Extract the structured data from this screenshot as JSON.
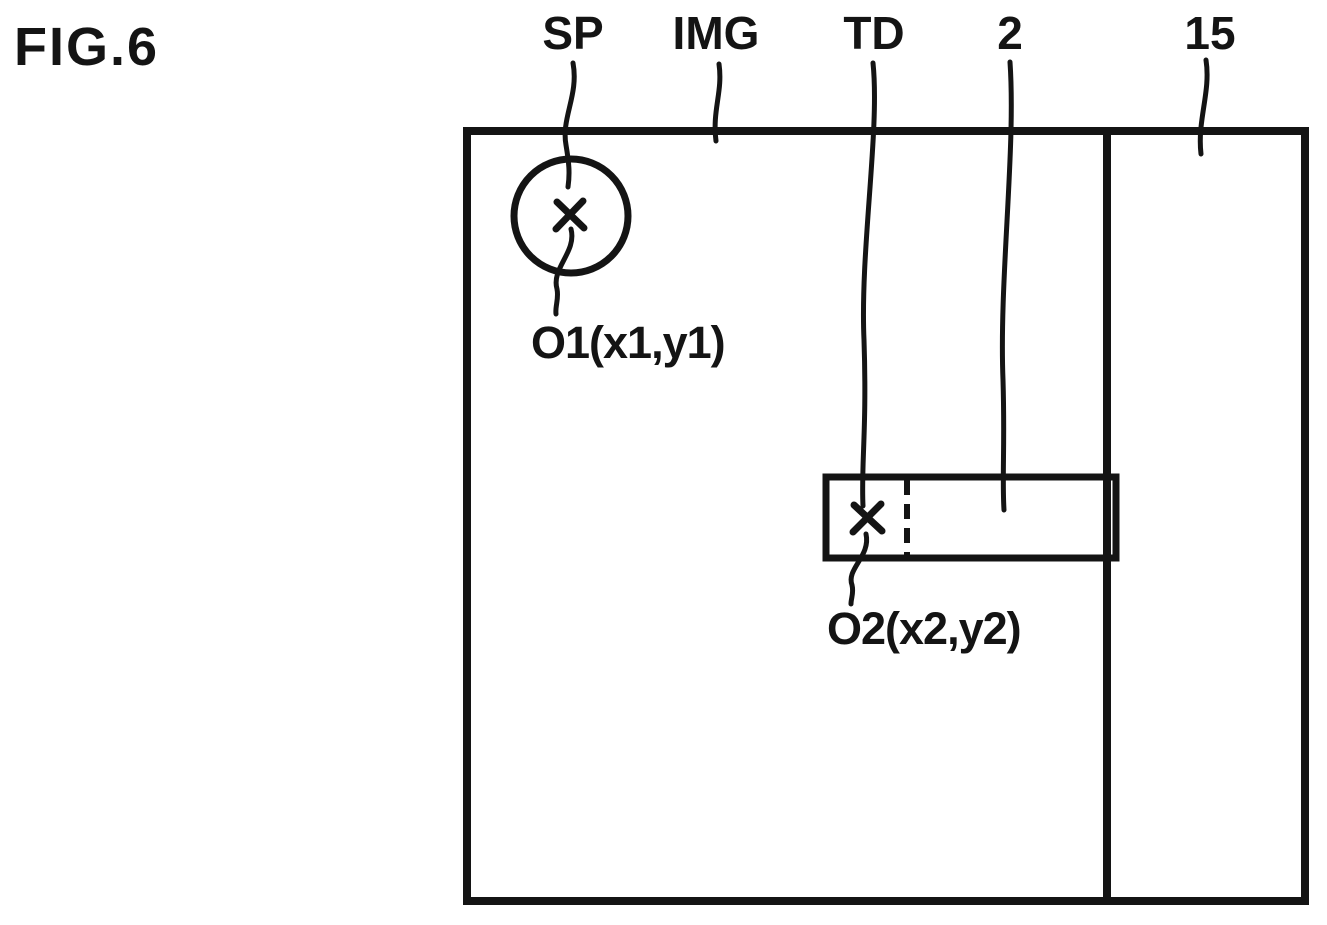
{
  "figure": {
    "title": "FIG.6",
    "reference_labels": {
      "sp": "SP",
      "img": "IMG",
      "td": "TD",
      "num2": "2",
      "num15": "15"
    },
    "point_labels": {
      "o1": "O1(x1,y1)",
      "o2": "O2(x2,y2)"
    },
    "icons": {
      "touch_mark_1": "x-cross-mark",
      "touch_mark_2": "x-cross-mark"
    },
    "colors": {
      "ink": "#141414",
      "background": "#ffffff"
    }
  }
}
